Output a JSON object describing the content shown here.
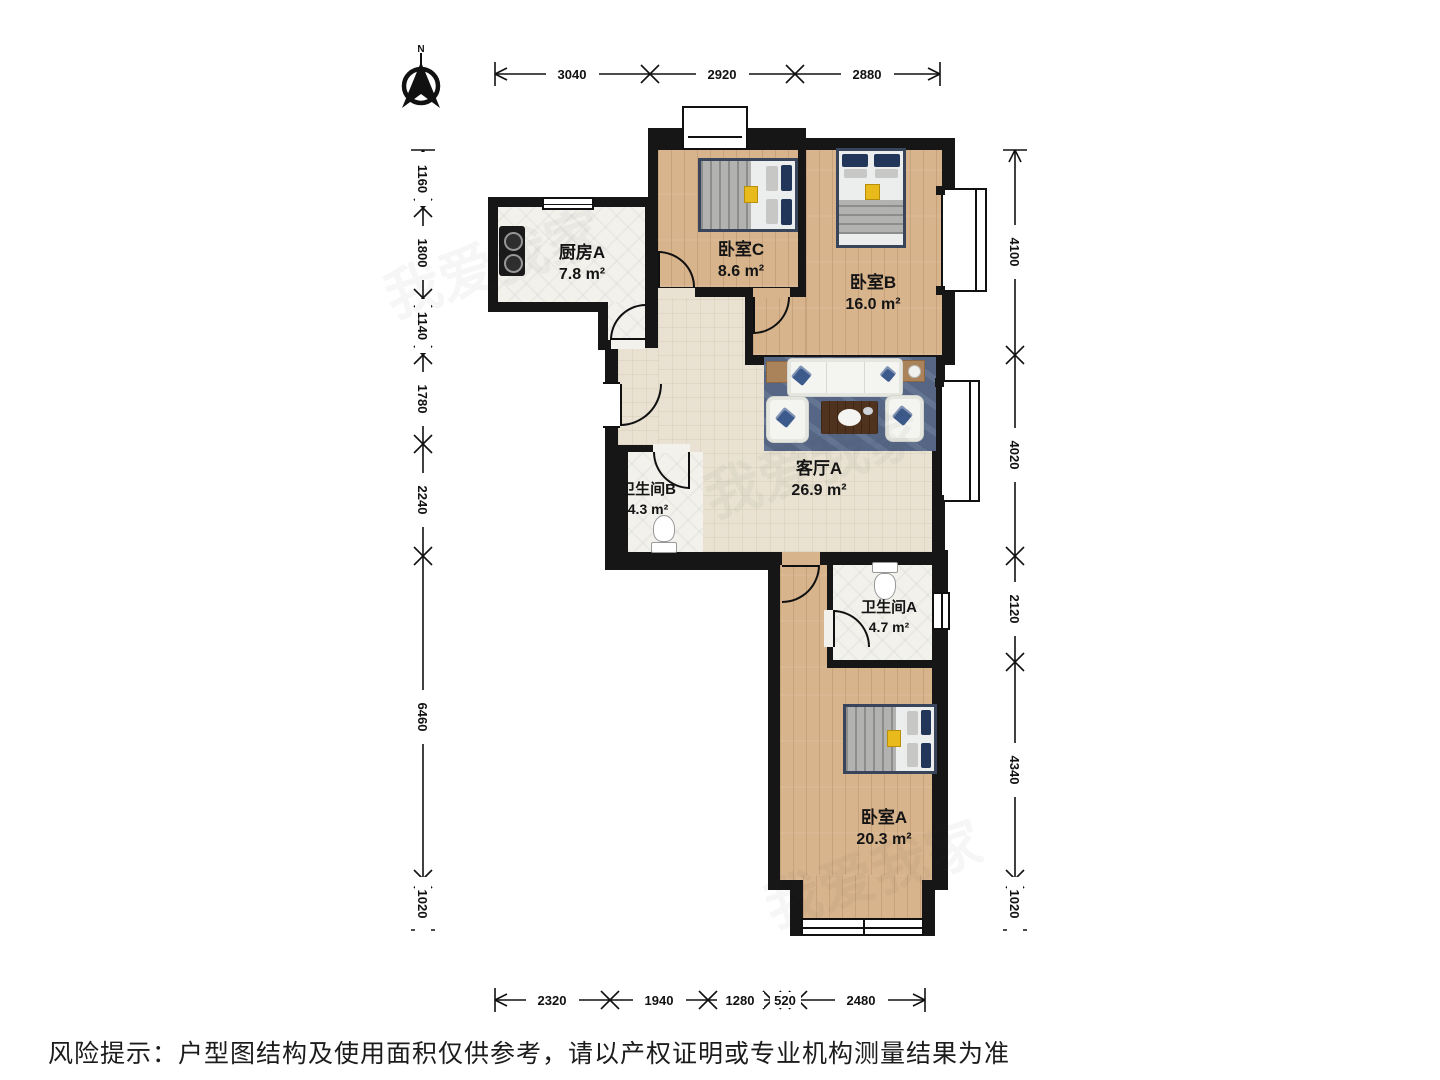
{
  "north": {
    "label": "N"
  },
  "rooms": [
    {
      "name": "厨房A",
      "area": "7.8 m²"
    },
    {
      "name": "卧室C",
      "area": "8.6 m²"
    },
    {
      "name": "卧室B",
      "area": "16.0 m²"
    },
    {
      "name": "客厅A",
      "area": "26.9 m²"
    },
    {
      "name": "卫生间B",
      "area": "4.3 m²"
    },
    {
      "name": "卫生间A",
      "area": "4.7 m²"
    },
    {
      "name": "卧室A",
      "area": "20.3 m²"
    }
  ],
  "dimensions_mm": {
    "top": [
      "3040",
      "2920",
      "2880"
    ],
    "left": [
      "1160",
      "1800",
      "1140",
      "1780",
      "2240",
      "6460",
      "1020"
    ],
    "right": [
      "4100",
      "4020",
      "2120",
      "4340",
      "1020"
    ],
    "bottom": [
      "2320",
      "1940",
      "1280",
      "520",
      "2480"
    ]
  },
  "disclaimer": "风险提示：户型图结构及使用面积仅供参考，请以产权证明或专业机构测量结果为准",
  "watermark": "我爱我家",
  "colors": {
    "wall": "#161616",
    "wood": "#d8b48d",
    "tile": "#f2f1ec",
    "living_floor": "#e9e2d2",
    "rug": "#5a6c8b",
    "pillow_accent": "#22365a"
  }
}
